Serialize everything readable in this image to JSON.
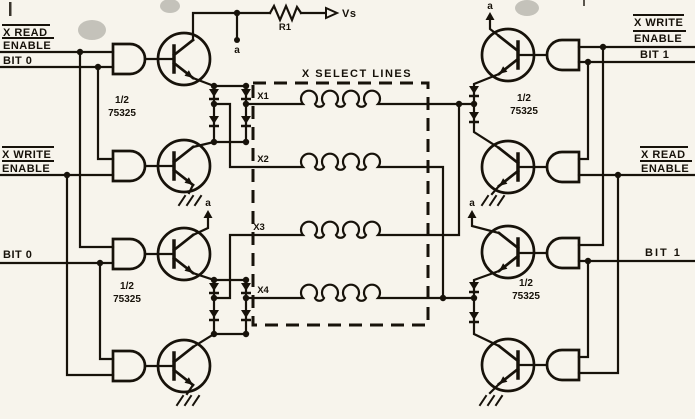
{
  "colors": {
    "paper": "#f7f4ec",
    "ink": "#17120a"
  },
  "power_rail": {
    "resistor_label": "R1",
    "supply_label": "Vs",
    "node_label": "a"
  },
  "select_box": {
    "title": "X SELECT LINES",
    "lines": [
      "X1",
      "X2",
      "X3",
      "X4"
    ]
  },
  "left": {
    "read_enable": {
      "line1": "X READ",
      "line2": "ENABLE"
    },
    "bit_top": "BIT 0",
    "write_enable": {
      "line1": "X WRITE",
      "line2": "ENABLE"
    },
    "bit_bottom": "BIT 0",
    "ic_top": {
      "line1": "1/2",
      "line2": "75325"
    },
    "ic_bottom": {
      "line1": "1/2",
      "line2": "75325"
    },
    "clamp_node": "a"
  },
  "right": {
    "write_enable": {
      "line1": "X WRITE",
      "line2": "ENABLE"
    },
    "bit_top": "BIT 1",
    "read_enable": {
      "line1": "X READ",
      "line2": "ENABLE"
    },
    "bit_bottom": "BIT 1",
    "ic_top": {
      "line1": "1/2",
      "line2": "75325"
    },
    "ic_bottom": {
      "line1": "1/2",
      "line2": "75325"
    },
    "clamp_node_top": "a",
    "clamp_node_mid": "a"
  }
}
